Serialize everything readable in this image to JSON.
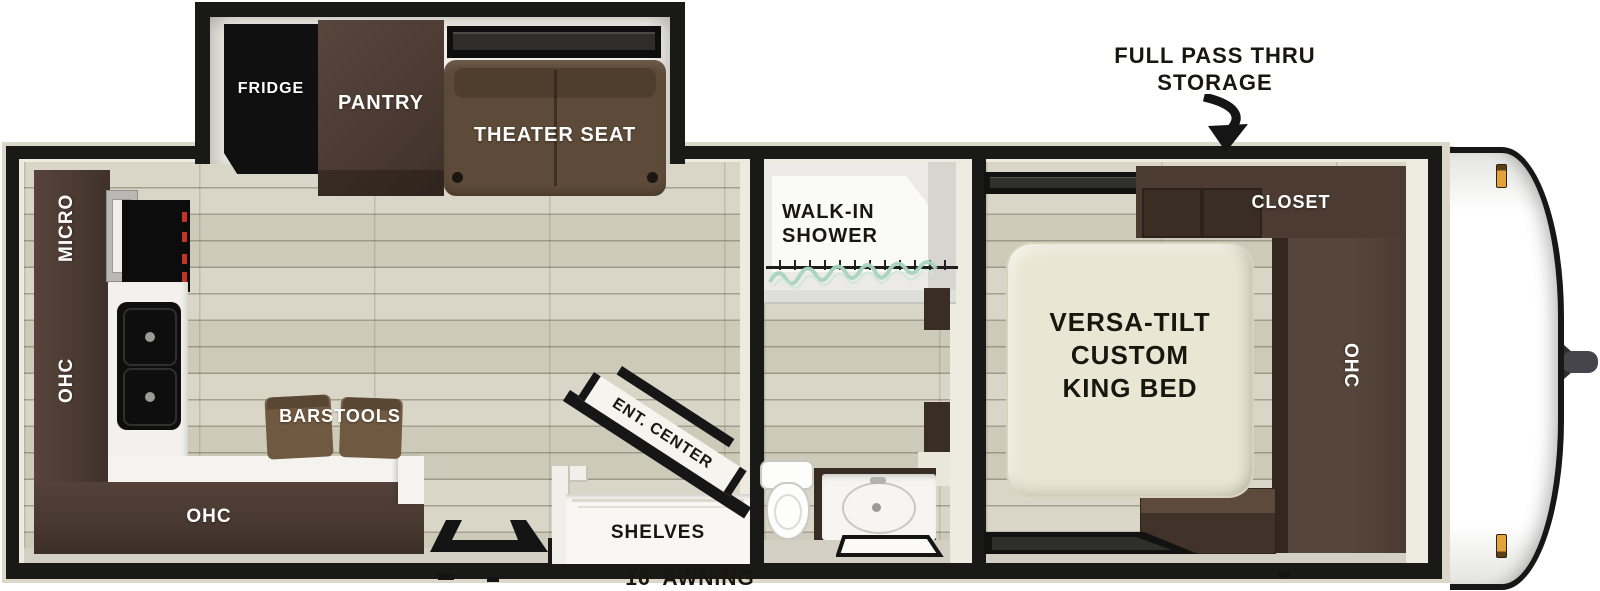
{
  "slideout": {
    "fridge": "FRIDGE",
    "pantry": "PANTRY",
    "theater_seat": "THEATER SEAT"
  },
  "kitchen": {
    "micro": "MICRO",
    "ohc_wall": "OHC",
    "ohc_lower": "OHC",
    "barstools": "BARSTOOLS"
  },
  "living": {
    "ent_center": "ENT. CENTER",
    "shelves": "SHELVES"
  },
  "bathroom": {
    "shower_line1": "WALK-IN",
    "shower_line2": "SHOWER"
  },
  "bedroom": {
    "bed_line1": "VERSA-TILT",
    "bed_line2": "CUSTOM",
    "bed_line3": "KING BED",
    "closet": "CLOSET",
    "ohc": "OHC"
  },
  "annotations": {
    "storage_line1": "FULL PASS THRU",
    "storage_line2": "STORAGE",
    "awning": "16’ AWNING"
  },
  "colors": {
    "wall": "#191917",
    "cabinet_brown": "#4c3b31",
    "seat_brown": "#5d4a38",
    "bed_cream": "#eae6d4",
    "floor_wood": "#d7d3c3",
    "marker_amber": "#e2a23c",
    "curtain_green": "#a8d4bc"
  }
}
